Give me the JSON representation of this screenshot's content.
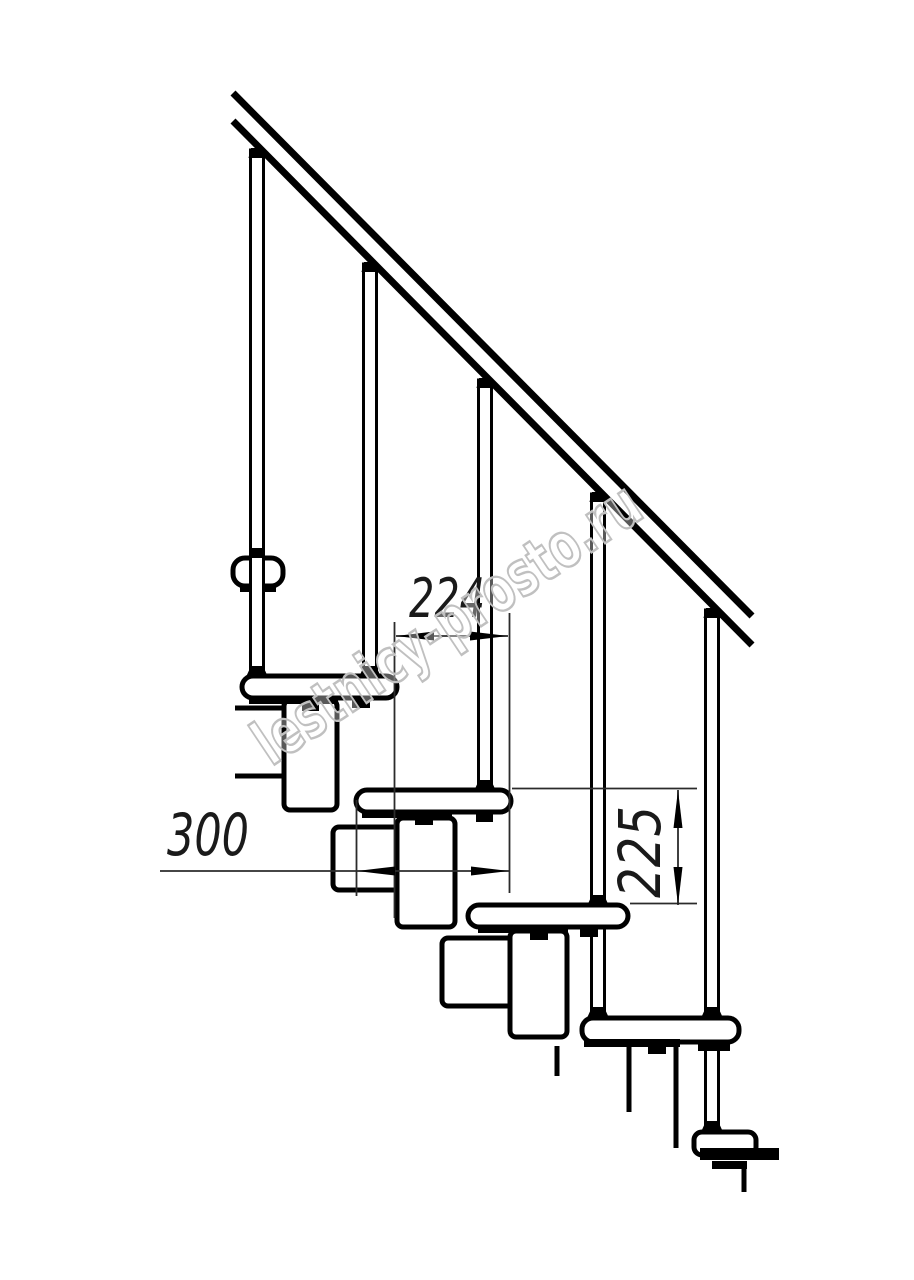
{
  "page": {
    "background": "#ffffff",
    "width_px": 914,
    "height_px": 1280
  },
  "drawing": {
    "type": "technical-line-drawing",
    "subject": "modular staircase side view with handrail and balusters",
    "colors": {
      "line": "#000000",
      "dimension": "#2b2b2b",
      "watermark": "#c0c0c0",
      "background": "#ffffff"
    },
    "dimensions": {
      "step_run": "224",
      "tread_depth": "300",
      "riser_height": "225"
    },
    "watermark": {
      "text": "lestnicy-prosto.ru"
    }
  }
}
